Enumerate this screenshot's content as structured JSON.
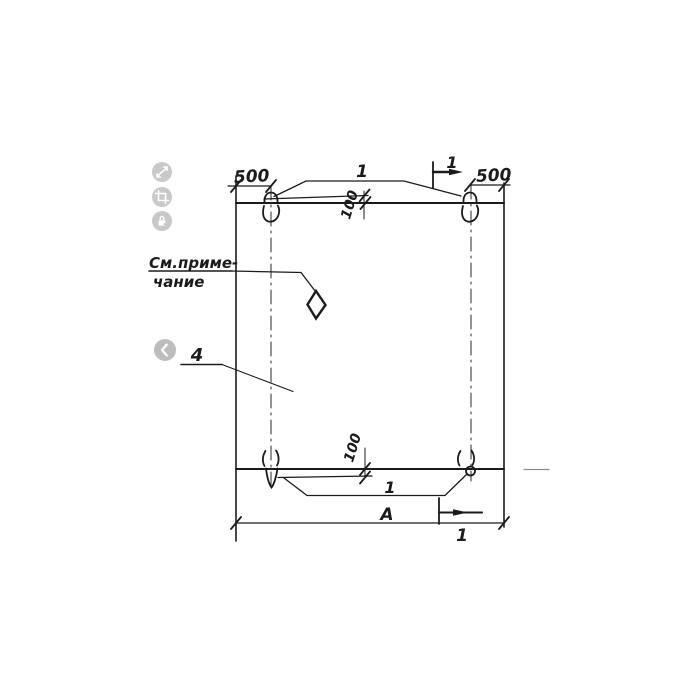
{
  "viewer_overlay": {
    "tool_buttons": [
      {
        "icon": "expand-icon"
      },
      {
        "icon": "crop-icon"
      },
      {
        "icon": "lock-icon"
      }
    ],
    "nav_button_icon": "chevron-left-icon",
    "colors": {
      "tool_button": "#c9c9c9",
      "nav_button": "#bdbdbd"
    }
  },
  "drawing": {
    "type": "technical-drawing",
    "note": {
      "line1": "См.приме-",
      "line2": "чание"
    },
    "position_labels": {
      "loops_top": "1",
      "loops_bottom": "1",
      "panel": "4"
    },
    "section_marks": {
      "top": "1",
      "bottom": "1"
    },
    "dimensions": {
      "left_loop_offset": "500",
      "right_loop_offset": "500",
      "top_inset": "100",
      "bottom_inset": "100",
      "overall_width": "А"
    },
    "colors": {
      "line": "#1b1b1b",
      "faint_line": "#909090"
    }
  }
}
